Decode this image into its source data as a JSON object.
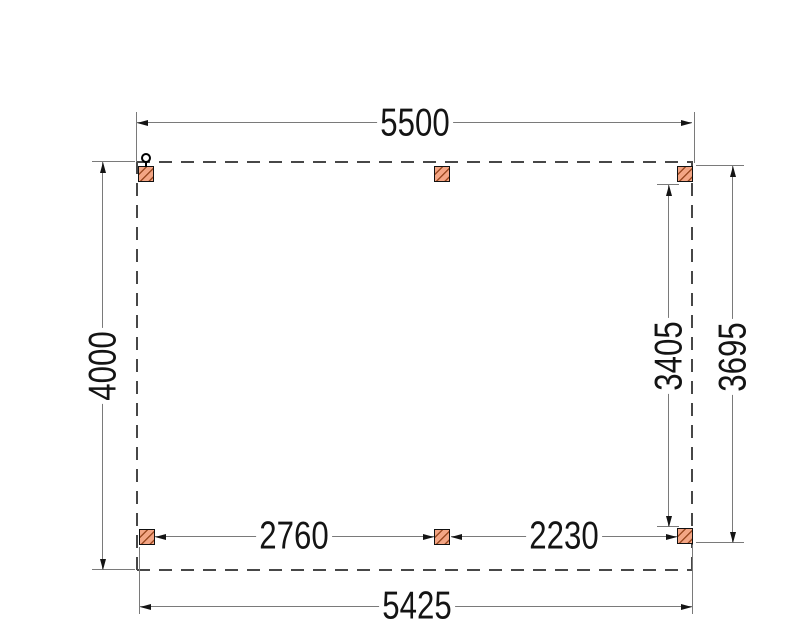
{
  "dim": {
    "top_width": "5500",
    "left_depth": "4000",
    "bottom_beam": "5425",
    "right_inner": "3405",
    "right_outer": "3695",
    "bottom_left_span": "2760",
    "bottom_right_span": "2230"
  },
  "posts": [
    {
      "id": "top-left"
    },
    {
      "id": "top-middle"
    },
    {
      "id": "top-right"
    },
    {
      "id": "bottom-left"
    },
    {
      "id": "bottom-middle"
    },
    {
      "id": "bottom-right"
    }
  ],
  "colors": {
    "post_fill": "#f3a584",
    "post_hatch": "#9c4a22",
    "line_gray": "#7a7a7a",
    "dash_color": "#474747",
    "ink": "#141414"
  }
}
